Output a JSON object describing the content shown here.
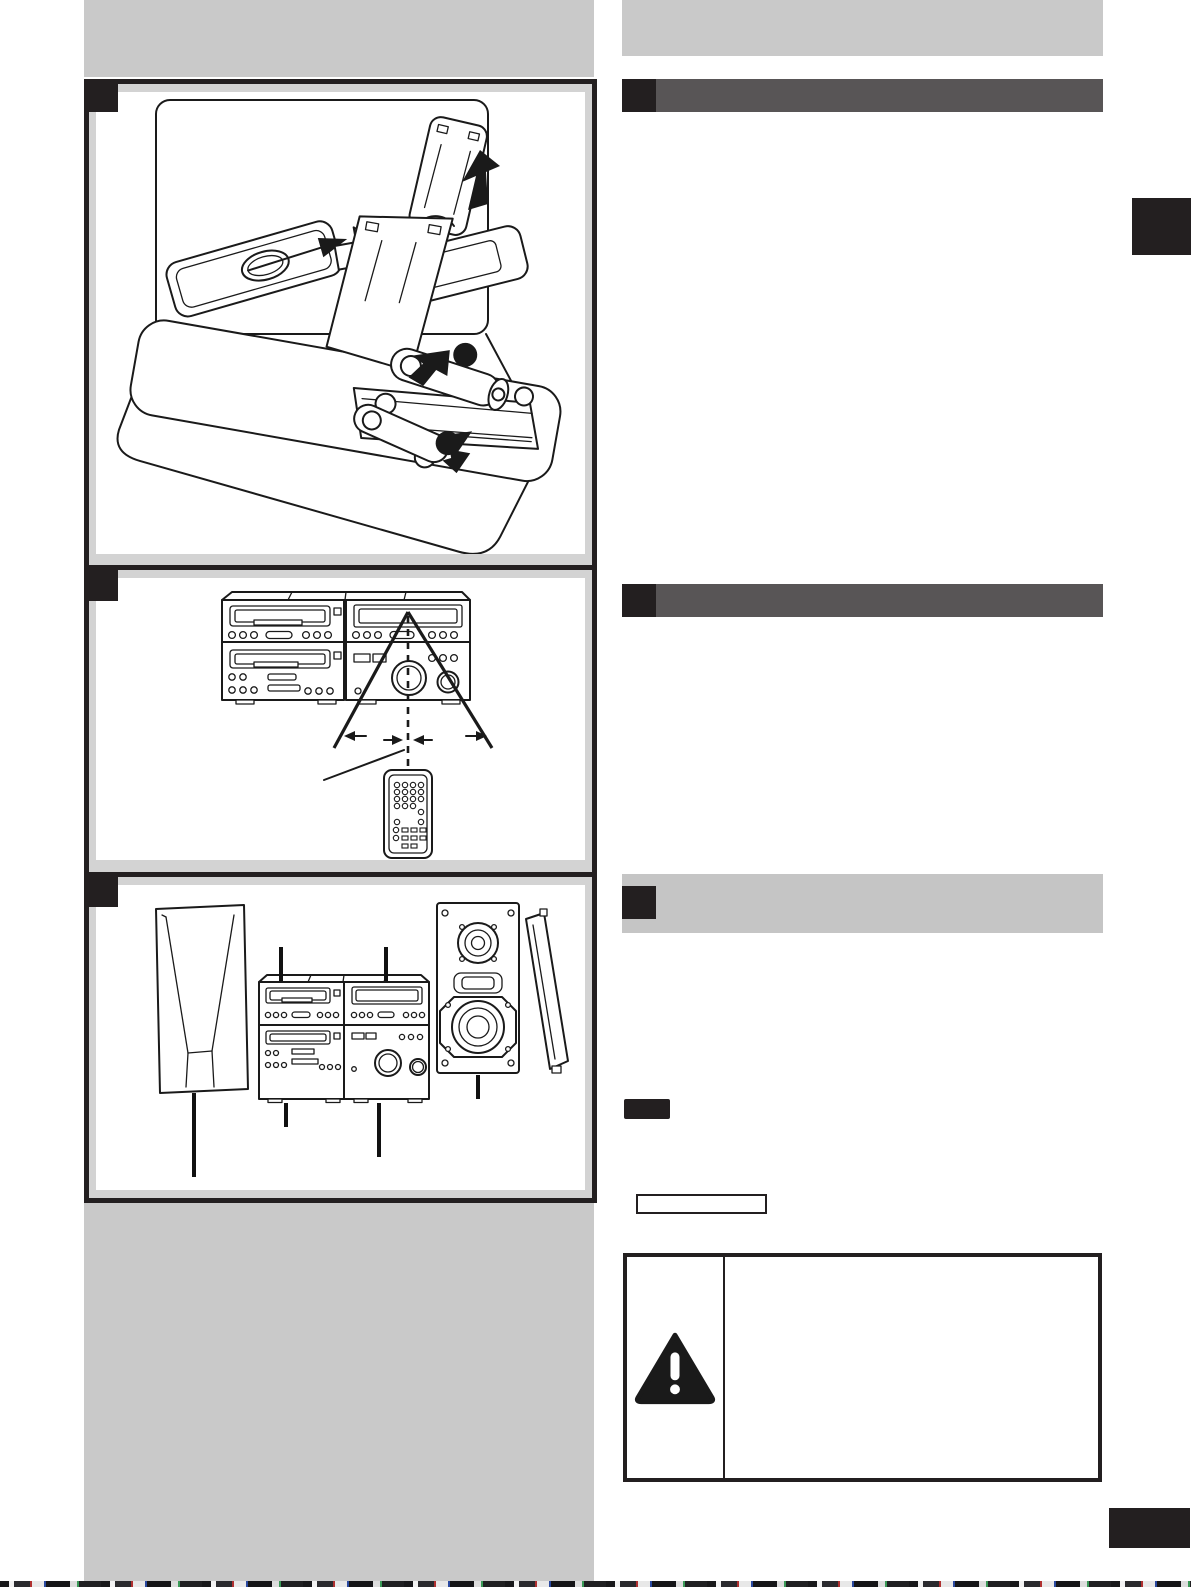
{
  "page": {
    "width": 1191,
    "height": 1587,
    "background": "#ffffff"
  },
  "colors": {
    "panel_gray": "#c9c9c9",
    "margin_gray": "#d3d3d3",
    "header_dark": "#585556",
    "header_light": "#c5c5c5",
    "ink": "#231f20",
    "line_art": "#1a1a1a",
    "paper": "#ffffff"
  },
  "left_column": {
    "title_strip_text": "",
    "figures": [
      {
        "id": "battery-installation",
        "marker_text": "",
        "illustration": "two remote controls with battery cover removal, open compartment with two batteries, step dots and arrows"
      },
      {
        "id": "remote-sensor-range",
        "marker_text": "",
        "illustration": "stereo system front with dashed beam line, sensor angle lines and remote control"
      },
      {
        "id": "speaker-placement",
        "marker_text": "",
        "illustration": "left speaker, stereo stack, right speaker with grille removed, leader lines"
      }
    ]
  },
  "right_column": {
    "title_strip_text": "",
    "sections": [
      {
        "id": "section-1",
        "style": "dark",
        "marker_text": "",
        "heading_text": ""
      },
      {
        "id": "section-2",
        "style": "dark",
        "marker_text": "",
        "heading_text": ""
      },
      {
        "id": "section-3",
        "style": "light",
        "marker_text": "",
        "heading_text": ""
      }
    ],
    "note_badge_text": "",
    "reference_box_text": "",
    "caution_box": {
      "icon": "warning-triangle-icon",
      "text": ""
    },
    "tabs": [
      {
        "id": "side-tab"
      },
      {
        "id": "bottom-tab"
      }
    ]
  }
}
